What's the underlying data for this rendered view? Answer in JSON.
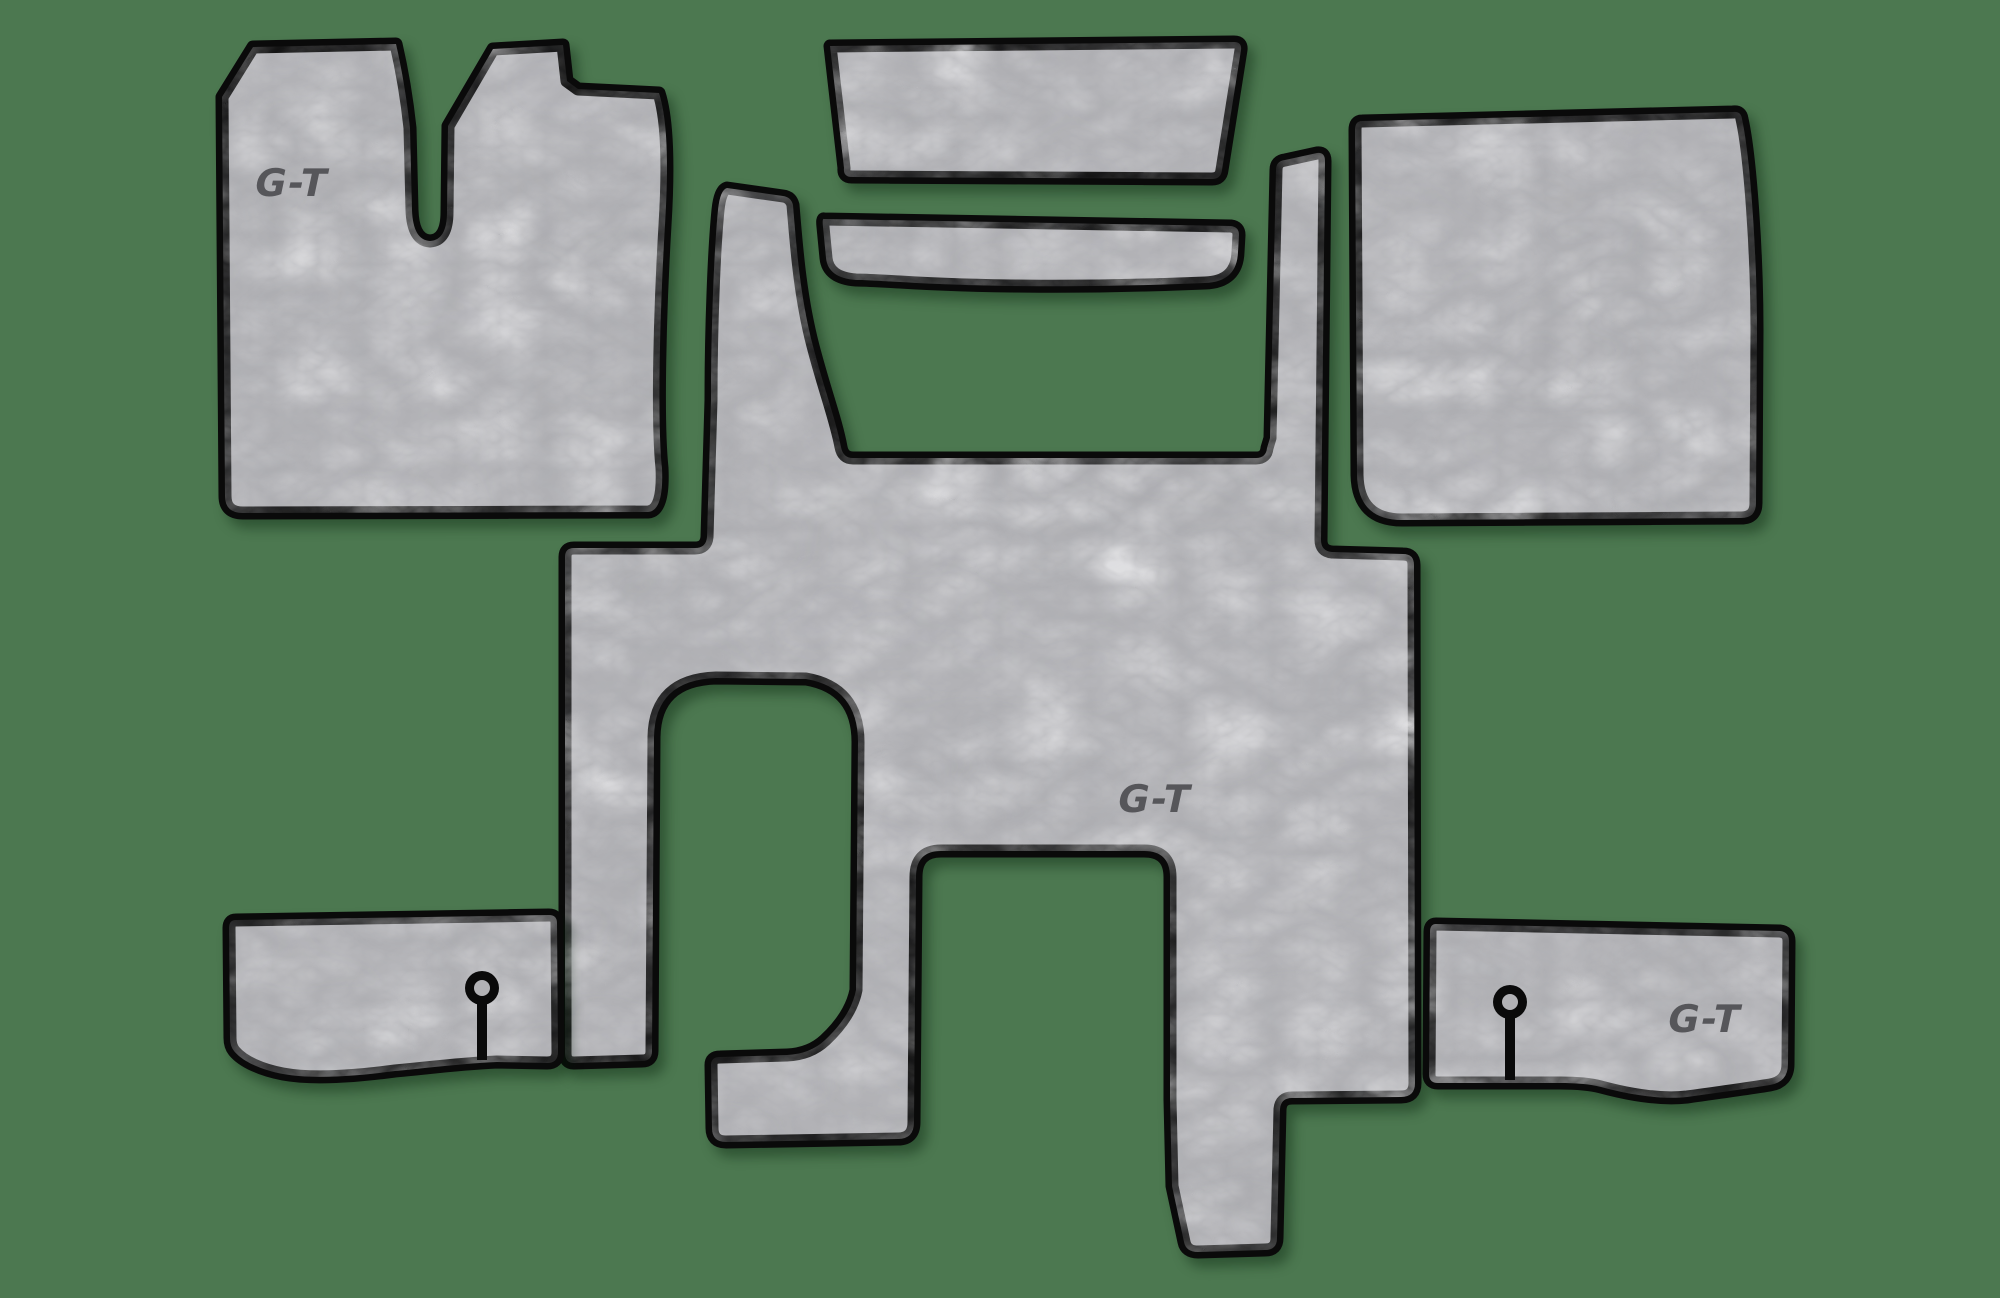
{
  "meta": {
    "description": "Product image of a seven-piece grey leatherette truck cab floor mat set with black trimmed edges, laid out on a green background"
  },
  "colors": {
    "background": "#4c7850",
    "mat_base": "#b2b2b6",
    "mat_vein": "#e4e4e6",
    "mat_shade": "#9fa0a4",
    "outline": "#0a0a0a",
    "logo": "#56565a"
  },
  "branding": {
    "logo_text": "G-T"
  },
  "pieces": [
    {
      "id": "driver-floor-mat",
      "name": "Driver side floor mat with seat-base cutout",
      "logo": "G-T"
    },
    {
      "id": "engine-cover-mat",
      "name": "Engine cover top mat"
    },
    {
      "id": "engine-tunnel-strip",
      "name": "Engine tunnel strip mat"
    },
    {
      "id": "passenger-floor-mat",
      "name": "Passenger side floor mat"
    },
    {
      "id": "center-floor-mat",
      "name": "Central cabin floor mat with seat and tunnel cutouts",
      "logo": "G-T"
    },
    {
      "id": "left-sill-strip",
      "name": "Left sill strip with mounting slot"
    },
    {
      "id": "right-sill-strip",
      "name": "Right sill strip with mounting slot",
      "logo": "G-T"
    }
  ]
}
